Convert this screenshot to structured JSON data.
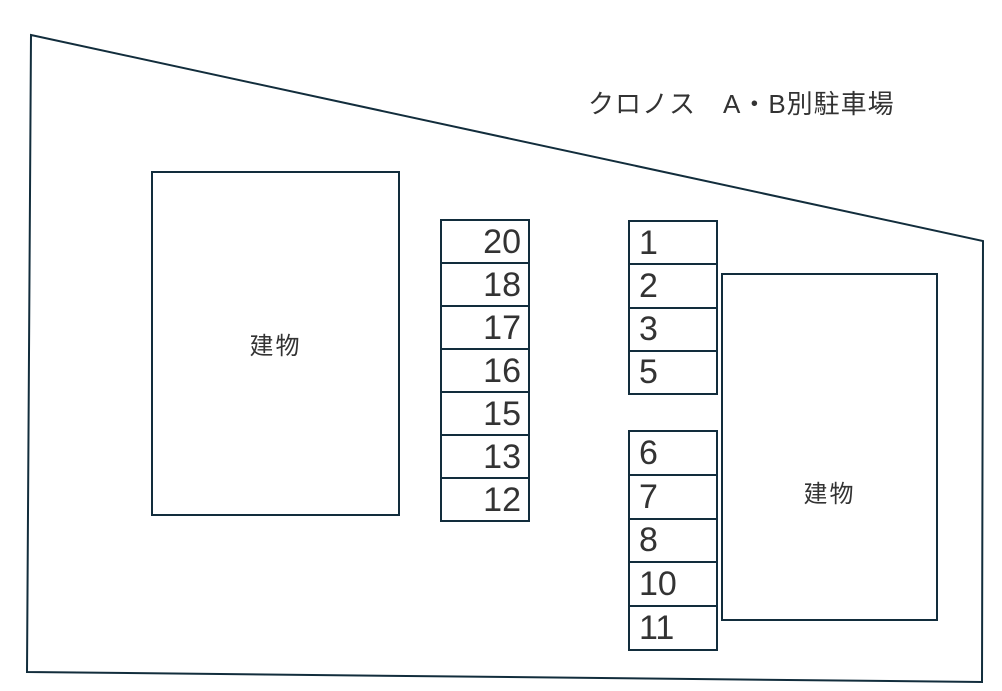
{
  "title": "クロノス　A・B別駐車場",
  "buildings": {
    "left": {
      "label": "建物"
    },
    "right": {
      "label": "建物"
    }
  },
  "stalls": {
    "middle": [
      "20",
      "18",
      "17",
      "16",
      "15",
      "13",
      "12"
    ],
    "right_upper": [
      "1",
      "2",
      "3",
      "5"
    ],
    "right_lower": [
      "6",
      "7",
      "8",
      "10",
      "11"
    ]
  },
  "colors": {
    "line": "#122d3c",
    "text": "#333333",
    "background": "#ffffff"
  }
}
